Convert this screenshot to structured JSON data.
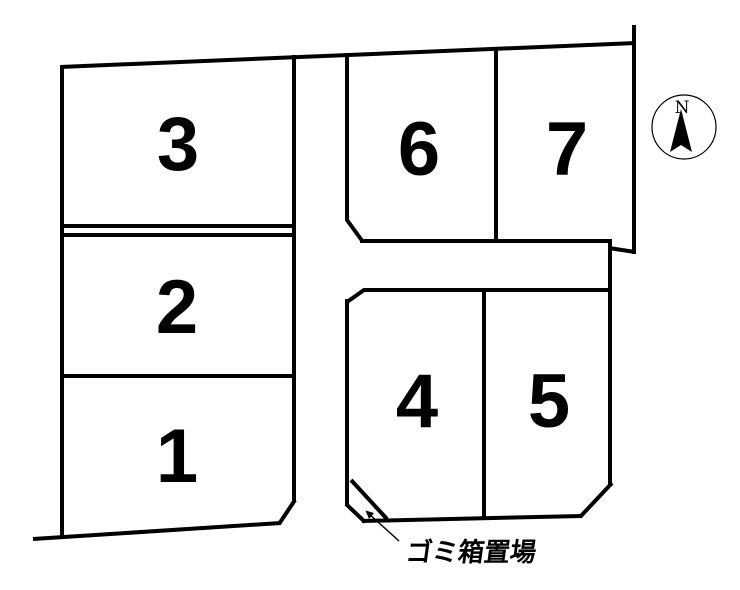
{
  "map": {
    "lots": [
      {
        "number": "1"
      },
      {
        "number": "2"
      },
      {
        "number": "3"
      },
      {
        "number": "4"
      },
      {
        "number": "5"
      },
      {
        "number": "6"
      },
      {
        "number": "7"
      }
    ],
    "labels": {
      "garbage_area": "ゴミ箱置場"
    },
    "compass": {
      "north": "N"
    },
    "colors": {
      "line": "#000000",
      "background": "#ffffff"
    }
  }
}
